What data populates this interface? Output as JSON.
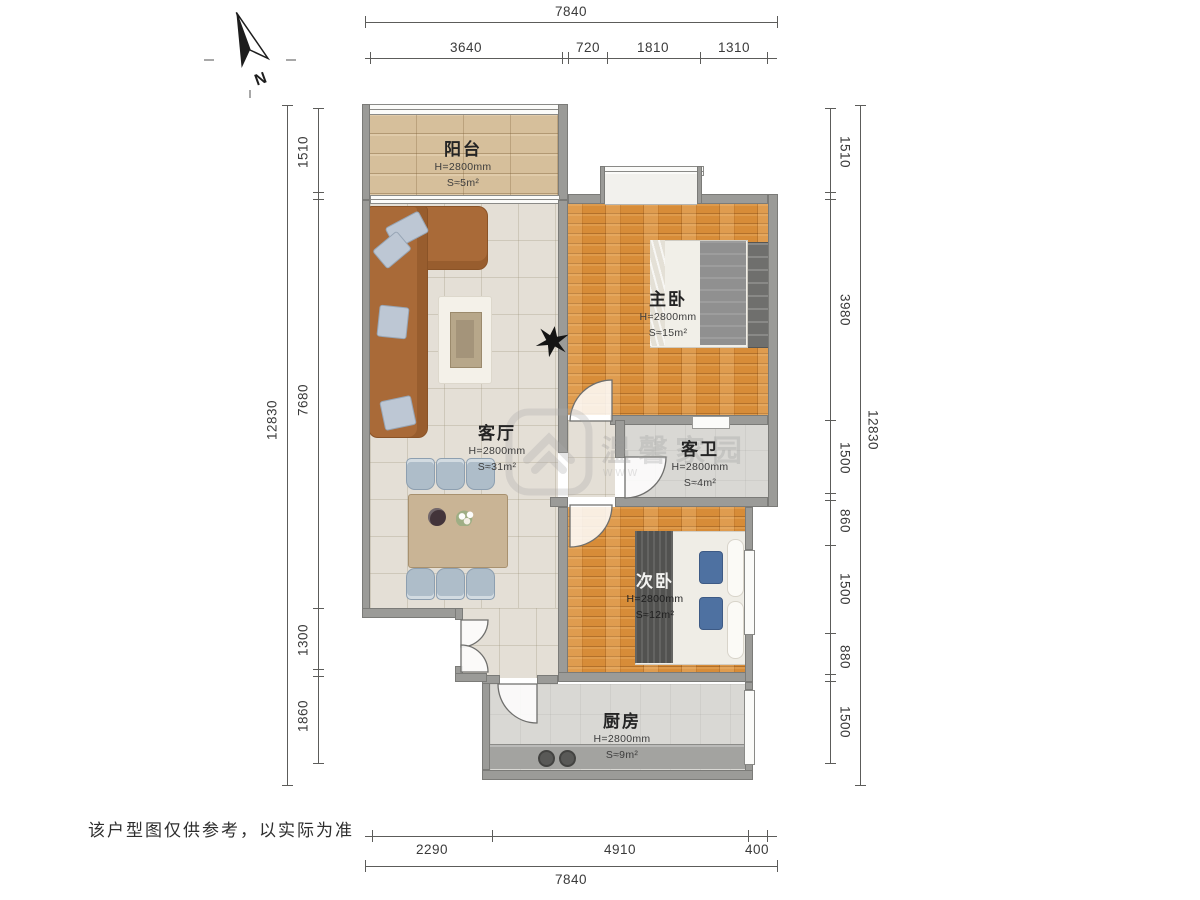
{
  "north_label": "N",
  "disclaimer": "该户型图仅供参考，以实际为准",
  "watermark": {
    "text": "温馨家园",
    "sub": "www"
  },
  "rooms": {
    "balcony": {
      "name": "阳台",
      "height": "H=2800mm",
      "area": "S≈5m²"
    },
    "master": {
      "name": "主卧",
      "height": "H=2800mm",
      "area": "S≈15m²"
    },
    "living": {
      "name": "客厅",
      "height": "H=2800mm",
      "area": "S≈31m²"
    },
    "bath": {
      "name": "客卫",
      "height": "H=2800mm",
      "area": "S≈4m²"
    },
    "second": {
      "name": "次卧",
      "height": "H=2800mm",
      "area": "S≈12m²"
    },
    "kitchen": {
      "name": "厨房",
      "height": "H=2800mm",
      "area": "S≈9m²"
    }
  },
  "dimensions": {
    "top": {
      "total": "7840",
      "segments": [
        "3640",
        "720",
        "1810",
        "1310"
      ]
    },
    "bottom": {
      "total": "7840",
      "segments": [
        "2290",
        "4910",
        "400"
      ]
    },
    "left": {
      "total": "12830",
      "segments": [
        "1510",
        "7680",
        "1300",
        "1860"
      ]
    },
    "right": {
      "total": "12830",
      "segments": [
        "1510",
        "3980",
        "1500",
        "860",
        "1500",
        "880",
        "1500"
      ]
    }
  },
  "colors": {
    "wall": "#9b9b98",
    "wood": "#d78c38",
    "tile": "#e4dfd6",
    "dim_line": "#5c5c5a"
  }
}
